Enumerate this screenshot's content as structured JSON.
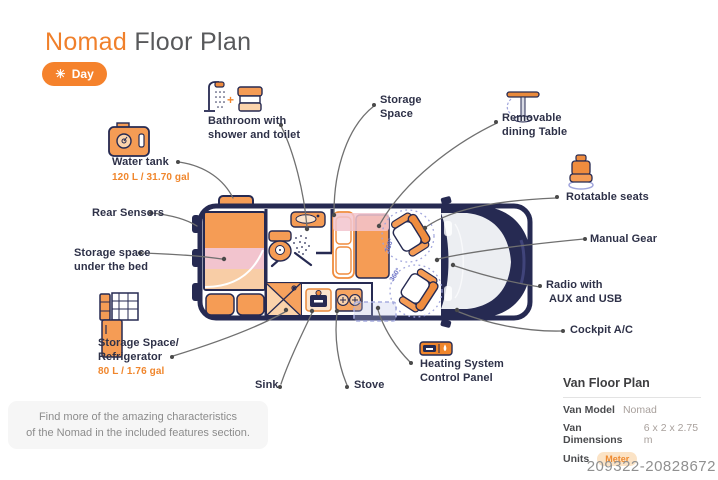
{
  "header": {
    "title_accent": "Nomad",
    "title_rest": "Floor Plan",
    "mode_label": "Day"
  },
  "icons": {
    "sun_glyph": "☀",
    "plus_glyph": "+"
  },
  "diagram": {
    "rotation_label": "360°"
  },
  "callouts": {
    "water_tank": {
      "label": "Water tank",
      "value": "120 L / 31.70 gal"
    },
    "rear_sensors": {
      "label": "Rear Sensors"
    },
    "storage_under_bed": {
      "line1": "Storage space",
      "line2": "under the bed"
    },
    "bathroom": {
      "line1": "Bathroom with",
      "line2": "shower and toilet"
    },
    "storage_space": {
      "line1": "Storage",
      "line2": "Space"
    },
    "removable_table": {
      "line1": "Removable",
      "line2": "dining Table"
    },
    "rotatable_seats": {
      "label": "Rotatable seats"
    },
    "manual_gear": {
      "label": "Manual Gear"
    },
    "radio": {
      "line1": "Radio with",
      "line2": "AUX and USB"
    },
    "cockpit_ac": {
      "label": "Cockpit A/C"
    },
    "heating": {
      "line1": "Heating System",
      "line2": "Control Panel"
    },
    "stove": {
      "label": "Stove"
    },
    "sink": {
      "label": "Sink"
    },
    "refrigerator": {
      "line1": "Storage Space/",
      "line2": "Refrigerator",
      "value": "80 L / 1.76 gal"
    }
  },
  "footer_note": {
    "line1": "Find more of the amazing characteristics",
    "line2": "of the Nomad in the included features section."
  },
  "info_panel": {
    "title": "Van Floor Plan",
    "model_label": "Van Model",
    "model_value": "Nomad",
    "dims_label": "Van Dimensions",
    "dims_value": "6 x 2 x 2.75 m",
    "units_label": "Units",
    "units_value": "Meter"
  },
  "watermark": "209322-20828672",
  "colors": {
    "accent_orange": "#F0862C",
    "navy": "#262A52",
    "pink": "#F2C4CE",
    "lavender": "#A0A5DC",
    "line_gray": "#707070"
  }
}
